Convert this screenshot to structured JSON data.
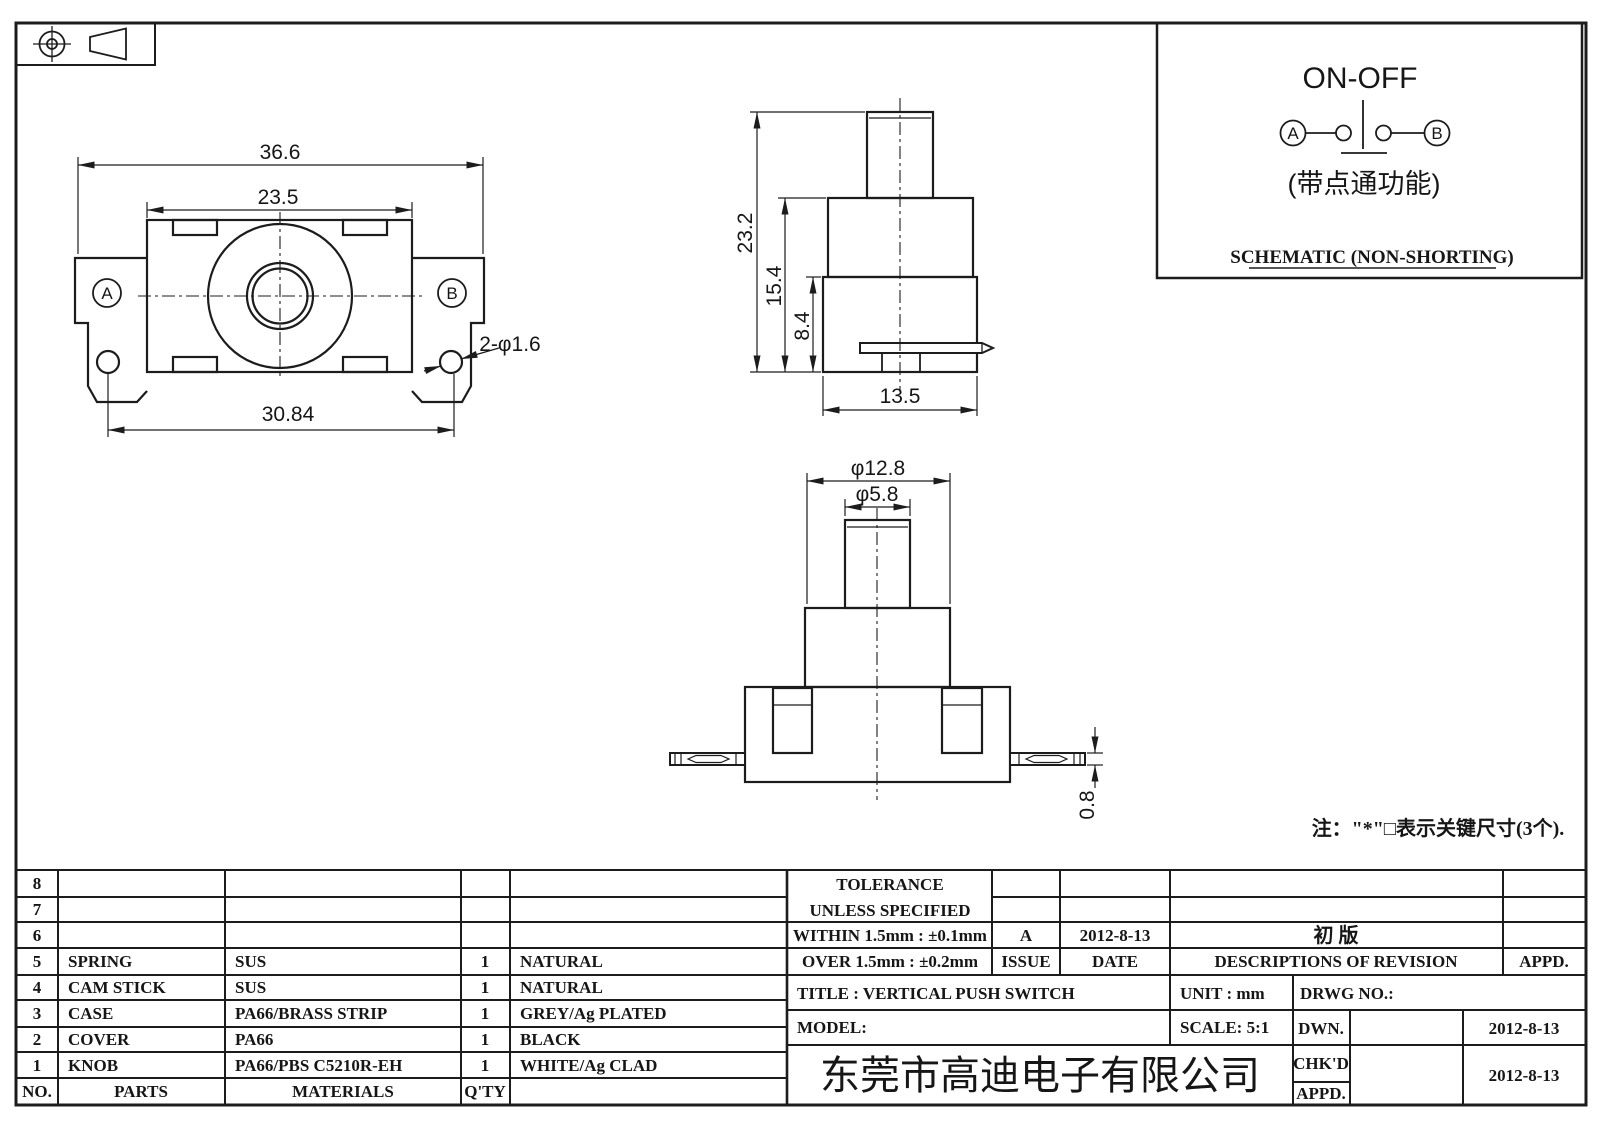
{
  "schematic": {
    "title": "ON-OFF",
    "terminal_a": "A",
    "terminal_b": "B",
    "subtitle": "(带点通功能)",
    "caption": "SCHEMATIC (NON-SHORTING)"
  },
  "views": {
    "front": {
      "dim_overall": "36.6",
      "dim_body": "23.5",
      "dim_span": "30.84",
      "dim_holes": "2-φ1.6",
      "label_a": "A",
      "label_b": "B"
    },
    "side": {
      "dim_total_h": "23.2",
      "dim_mid_h": "15.4",
      "dim_base_h": "8.4",
      "dim_base_w": "13.5"
    },
    "bottom": {
      "dim_body_dia": "φ12.8",
      "dim_stem_dia": "φ5.8",
      "dim_pin_t": "0.8"
    }
  },
  "note": "注：\"*\"□表示关键尺寸(3个).",
  "parts_table": {
    "footer": {
      "no": "NO.",
      "parts": "PARTS",
      "materials": "MATERIALS",
      "qty": "Q'TY"
    },
    "rows": [
      {
        "no": "8",
        "part": "",
        "material": "",
        "qty": "",
        "finish": ""
      },
      {
        "no": "7",
        "part": "",
        "material": "",
        "qty": "",
        "finish": ""
      },
      {
        "no": "6",
        "part": "",
        "material": "",
        "qty": "",
        "finish": ""
      },
      {
        "no": "5",
        "part": "SPRING",
        "material": "SUS",
        "qty": "1",
        "finish": "NATURAL"
      },
      {
        "no": "4",
        "part": "CAM STICK",
        "material": "SUS",
        "qty": "1",
        "finish": "NATURAL"
      },
      {
        "no": "3",
        "part": "CASE",
        "material": "PA66/BRASS STRIP",
        "qty": "1",
        "finish": "GREY/Ag PLATED"
      },
      {
        "no": "2",
        "part": "COVER",
        "material": "PA66",
        "qty": "1",
        "finish": "BLACK"
      },
      {
        "no": "1",
        "part": "KNOB",
        "material": "PA66/PBS C5210R-EH",
        "qty": "1",
        "finish": "WHITE/Ag CLAD"
      }
    ]
  },
  "tolerance": {
    "line1": "TOLERANCE",
    "line2": "UNLESS  SPECIFIED",
    "within": "WITHIN 1.5mm : ±0.1mm",
    "over": "OVER 1.5mm : ±0.2mm"
  },
  "revision": {
    "issue_value": "A",
    "date_value": "2012-8-13",
    "description_value": "初  版",
    "issue_label": "ISSUE",
    "date_label": "DATE",
    "desc_label": "DESCRIPTIONS OF REVISION",
    "appd_label": "APPD."
  },
  "title_block": {
    "title": "TITLE :  VERTICAL PUSH SWITCH",
    "unit": "UNIT :  mm",
    "drwg": "DRWG NO.:",
    "model": "MODEL:",
    "scale": "SCALE:  5:1",
    "dwn_label": "DWN.",
    "chkd_label": "CHK'D",
    "appd_label": "APPD.",
    "dwn_date": "2012-8-13",
    "chkd_date": "2012-8-13",
    "company": "东莞市高迪电子有限公司",
    "company_color": "#d0271b"
  }
}
